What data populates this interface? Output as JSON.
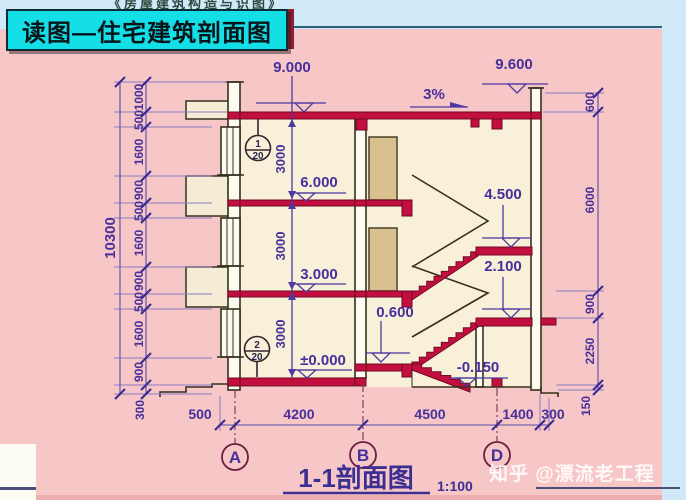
{
  "header": {
    "top_note": "《房屋建筑构造与识图》",
    "title": "读图—住宅建筑剖面图"
  },
  "drawing": {
    "levels": {
      "roof_left": "9.000",
      "parapet_right": "9.600",
      "slope": "3%",
      "floor3": "6.000",
      "floor2": "3.000",
      "ground": "±0.000",
      "entry_landing": "0.600",
      "mid_landing_upper": "4.500",
      "mid_landing_lower": "2.100",
      "outdoor": "-0.150"
    },
    "callouts": {
      "c1_num": "1",
      "c1_den": "20",
      "c2_num": "2",
      "c2_den": "20"
    },
    "dims": {
      "overall_left": "10300",
      "left_chain": [
        "1000",
        "500",
        "1600",
        "900",
        "500",
        "1600",
        "900",
        "500",
        "1600",
        "900",
        "300"
      ],
      "right_chain": [
        "600",
        "6000",
        "900",
        "2250",
        "150"
      ],
      "bottom_chain": [
        "500",
        "4200",
        "4500",
        "1400",
        "300"
      ],
      "floor_heights": [
        "3000",
        "3000",
        "3000"
      ]
    },
    "axes": [
      "A",
      "B",
      "D"
    ],
    "caption": {
      "title": "1-1剖面图",
      "scale": "1:100"
    }
  },
  "footer": {
    "watermark": "知乎 @漂流老工程"
  }
}
